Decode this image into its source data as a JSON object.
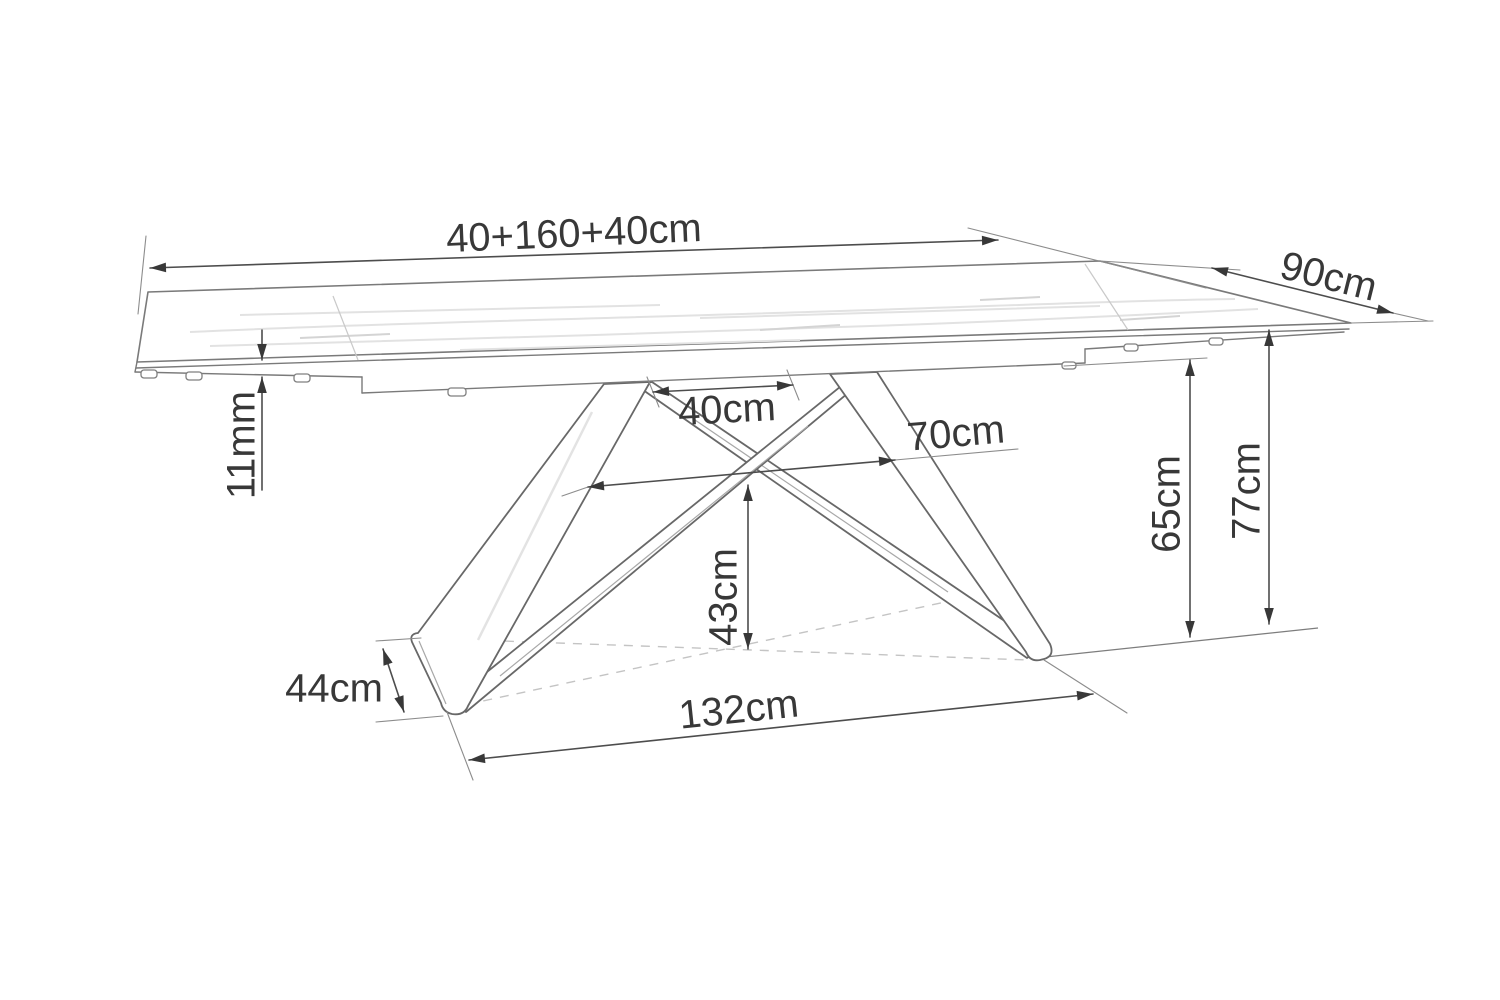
{
  "figure": {
    "type": "technical-dimension-drawing",
    "background": "#ffffff"
  },
  "colors": {
    "dimension_line": "#4d4d4d",
    "extension_line": "#8c8c8c",
    "label_text": "#383838",
    "artwork_outline": "#7a7a7a",
    "dashed_projection": "#c4c4c4"
  },
  "annotations": [
    {
      "id": "total-length",
      "text": "40+160+40cm",
      "segments": [
        {
          "x1": 150,
          "y1": 268,
          "x2": 998,
          "y2": 240,
          "arrows": "both"
        }
      ],
      "ext": [
        [
          146,
          236,
          138,
          314
        ],
        [
          968,
          228,
          1206,
          288
        ]
      ],
      "label": {
        "x": 574,
        "y": 236,
        "r": -2.5,
        "s": 40
      }
    },
    {
      "id": "depth",
      "text": "90cm",
      "segments": [
        {
          "x1": 1212,
          "y1": 268,
          "x2": 1393,
          "y2": 313,
          "arrows": "both"
        }
      ],
      "ext": [
        [
          1100,
          261,
          1240,
          270
        ],
        [
          1393,
          313,
          1428,
          321
        ],
        [
          1351,
          323,
          1433,
          321
        ]
      ],
      "label": {
        "x": 1328,
        "y": 279,
        "r": 14,
        "s": 40
      }
    },
    {
      "id": "top-thickness",
      "text": "11mm",
      "segments": [
        {
          "x1": 262,
          "y1": 330,
          "x2": 262,
          "y2": 360,
          "arrows": "end"
        },
        {
          "x1": 262,
          "y1": 377,
          "x2": 262,
          "y2": 490,
          "arrows": "start"
        }
      ],
      "ext": [],
      "label": {
        "x": 244,
        "y": 445,
        "r": -90,
        "s": 40
      }
    },
    {
      "id": "leg-top-spread",
      "text": "40cm",
      "segments": [
        {
          "x1": 653,
          "y1": 392,
          "x2": 793,
          "y2": 385,
          "arrows": "both"
        }
      ],
      "ext": [
        [
          647,
          377,
          659,
          407
        ],
        [
          787,
          370,
          799,
          400
        ]
      ],
      "label": {
        "x": 727,
        "y": 412,
        "r": -3,
        "s": 40
      }
    },
    {
      "id": "leg-mid-spread",
      "text": "70cm",
      "segments": [
        {
          "x1": 588,
          "y1": 487,
          "x2": 895,
          "y2": 460,
          "arrows": "both"
        }
      ],
      "ext": [
        [
          562,
          496,
          588,
          487
        ],
        [
          895,
          460,
          1018,
          449
        ]
      ],
      "label": {
        "x": 956,
        "y": 436,
        "r": -5,
        "s": 40
      }
    },
    {
      "id": "cross-height",
      "text": "43cm",
      "segments": [
        {
          "x1": 748,
          "y1": 485,
          "x2": 748,
          "y2": 649,
          "arrows": "both"
        }
      ],
      "ext": [],
      "label": {
        "x": 726,
        "y": 597,
        "r": -90,
        "s": 40
      }
    },
    {
      "id": "frame-height",
      "text": "65cm",
      "segments": [
        {
          "x1": 1190,
          "y1": 360,
          "x2": 1190,
          "y2": 637,
          "arrows": "both"
        }
      ],
      "ext": [
        [
          1064,
          366,
          1207,
          358
        ]
      ],
      "label": {
        "x": 1169,
        "y": 504,
        "r": -90,
        "s": 40
      }
    },
    {
      "id": "table-height",
      "text": "77cm",
      "segments": [
        {
          "x1": 1269,
          "y1": 330,
          "x2": 1269,
          "y2": 624,
          "arrows": "both"
        }
      ],
      "ext": [],
      "label": {
        "x": 1249,
        "y": 491,
        "r": -90,
        "s": 40
      }
    },
    {
      "id": "foot-length",
      "text": "44cm",
      "segments": [
        {
          "x1": 383,
          "y1": 649,
          "x2": 404,
          "y2": 712,
          "arrows": "both"
        }
      ],
      "ext": [
        [
          376,
          641,
          421,
          638
        ],
        [
          376,
          722,
          443,
          716
        ]
      ],
      "label": {
        "x": 334,
        "y": 691,
        "r": 0,
        "s": 40
      }
    },
    {
      "id": "base-length",
      "text": "132cm",
      "segments": [
        {
          "x1": 469,
          "y1": 760,
          "x2": 1093,
          "y2": 694,
          "arrows": "both"
        }
      ],
      "ext": [
        [
          447,
          712,
          473,
          780
        ],
        [
          1044,
          660,
          1127,
          713
        ]
      ],
      "label": {
        "x": 739,
        "y": 712,
        "r": -6,
        "s": 40
      }
    }
  ]
}
